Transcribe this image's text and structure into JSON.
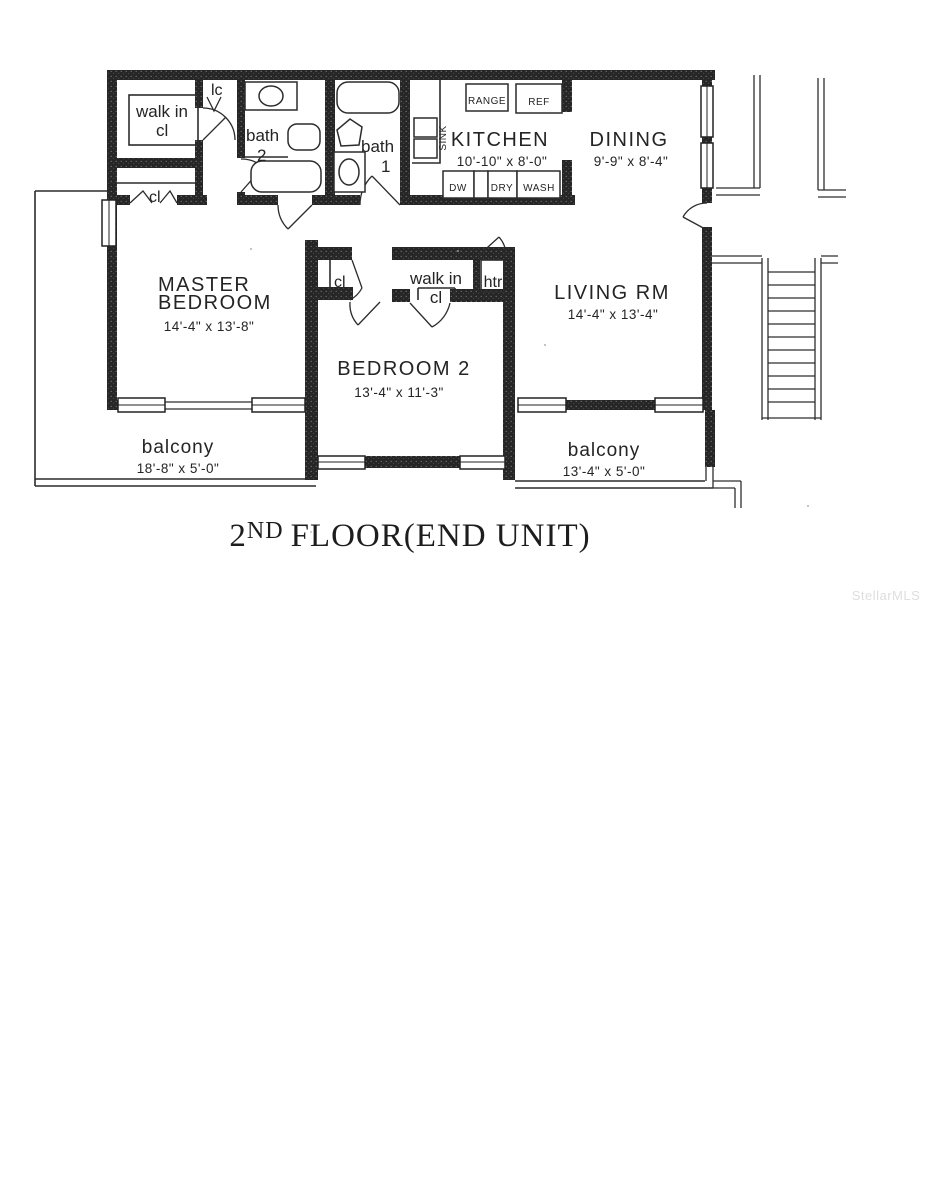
{
  "title": {
    "number": "2",
    "ordinal": "ND",
    "text": "FLOOR(END UNIT)"
  },
  "watermark": "StellarMLS",
  "rooms": {
    "master": {
      "name1": "MASTER",
      "name2": "BEDROOM",
      "dims": "14'-4\" x 13'-8\""
    },
    "bedroom2": {
      "name": "BEDROOM 2",
      "dims": "13'-4\" x 11'-3\""
    },
    "living": {
      "name": "LIVING RM",
      "dims": "14'-4\" x 13'-4\""
    },
    "kitchen": {
      "name": "KITCHEN",
      "dims": "10'-10\" x 8'-0\""
    },
    "dining": {
      "name": "DINING",
      "dims": "9'-9\" x 8'-4\""
    },
    "bath1": {
      "name": "bath",
      "number": "1"
    },
    "bath2": {
      "name": "bath",
      "number": "2"
    },
    "balcony_left": {
      "name": "balcony",
      "dims": "18'-8\" x 5'-0\""
    },
    "balcony_right": {
      "name": "balcony",
      "dims": "13'-4\" x 5'-0\""
    }
  },
  "closets": {
    "walk_in_master": {
      "line1": "walk in",
      "line2": "cl"
    },
    "walk_in_bedroom2": {
      "line1": "walk in",
      "line2": "cl"
    },
    "hall_closet": "cl",
    "linen_closet": "lc",
    "bedroom2_closet": "cl",
    "heater_closet": "htr"
  },
  "kitchen_fixtures": {
    "range": "RANGE",
    "ref": "REF",
    "sink": "SINK",
    "dw": "DW",
    "dry": "DRY",
    "wash": "WASH"
  }
}
